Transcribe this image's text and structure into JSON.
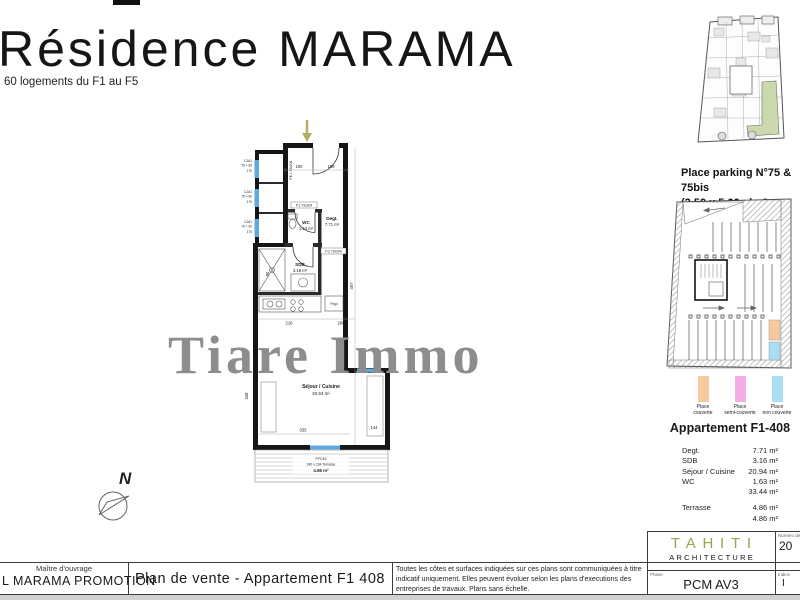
{
  "header": {
    "title": "Résidence MARAMA",
    "subtitle": "60 logements du F1 au F5"
  },
  "watermark": "Tiare Immo",
  "plan": {
    "north": "N",
    "entry_door_label": "PE.1 93x204",
    "door_wc_label": "P.1 73x204",
    "door_sdb_label": "P.2 73x204",
    "window_label": "CJA1",
    "window_size": "75 + 60",
    "window_sill": "170",
    "fridge_label": "Frigo",
    "rooms": {
      "degt": {
        "name": "Degt.",
        "area": "7.71 m²"
      },
      "wc": {
        "name": "WC",
        "area": "1.63 m²"
      },
      "sdb": {
        "name": "SDB",
        "area": "3.16 m²"
      },
      "sejour": {
        "name": "Séjour / Cuisine",
        "area": "20.94 m²"
      }
    },
    "terrace": {
      "code": "PFCA2",
      "dims": "240 x 234 Terrasse",
      "area": "4.86 m²"
    },
    "dims": {
      "d100": "100",
      "d109": "109",
      "d457": "457",
      "d90": "90",
      "d216": "216",
      "d200": "200",
      "d335": "335",
      "d144": "144",
      "d348": "348"
    }
  },
  "sidebar": {
    "parking_caption_line1": "Place parking N°75 & 75bis",
    "parking_caption_line2": "(2.50 x 5.00m) x2",
    "legend": [
      {
        "label_line1": "Place",
        "label_line2": "couverte",
        "color": "#f7c99c"
      },
      {
        "label_line1": "Place",
        "label_line2": "semi-couverte",
        "color": "#f2aee4"
      },
      {
        "label_line1": "Place",
        "label_line2": "non couverte",
        "color": "#a9ddf1"
      }
    ],
    "apartment": {
      "title": "Appartement F1-408",
      "rows": [
        {
          "label": "Degt.",
          "value": "7.71 m²"
        },
        {
          "label": "SDB",
          "value": "3.16 m²"
        },
        {
          "label": "Séjour / Cuisine",
          "value": "20.94 m²"
        },
        {
          "label": "WC",
          "value": "1.63 m²"
        },
        {
          "label": "",
          "value": "33.44 m²"
        },
        {
          "label": "Terrasse",
          "value": "4.86 m²"
        },
        {
          "label": "",
          "value": "4.86 m²"
        }
      ]
    }
  },
  "footer": {
    "owner_label": "Maître d'ouvrage",
    "owner_name": "L MARAMA PROMOTION",
    "plan_title": "Plan de vente - Appartement F1 408",
    "disclaimer": "Toutes les côtes et surfaces indiquées sur ces plans sont communiquées à titre indicatif uniquement. Elles peuvent évoluer selon les plans d'executions des entreprises de travaux. Plans sans échelle.",
    "architect_name": "TAHITI",
    "architect_sub": "ARCHITECTURE",
    "phase_label": "Phase",
    "phase_value": "PCM AV3",
    "dossier_label": "Numéro de dossier",
    "dossier_value": "20",
    "indice_label": "Indice",
    "indice_value": "I"
  },
  "colors": {
    "highlight_unit_green": "#ccd8ad",
    "entry_arrow_olive": "#b3b061",
    "window_blue": "#5ea9dd",
    "tahiti_green": "#9aa24c",
    "watermark_gray": "#8d8d8d",
    "parking_covered": "#f7c99c",
    "parking_semi": "#f2aee4",
    "parking_open": "#a9ddf1"
  }
}
